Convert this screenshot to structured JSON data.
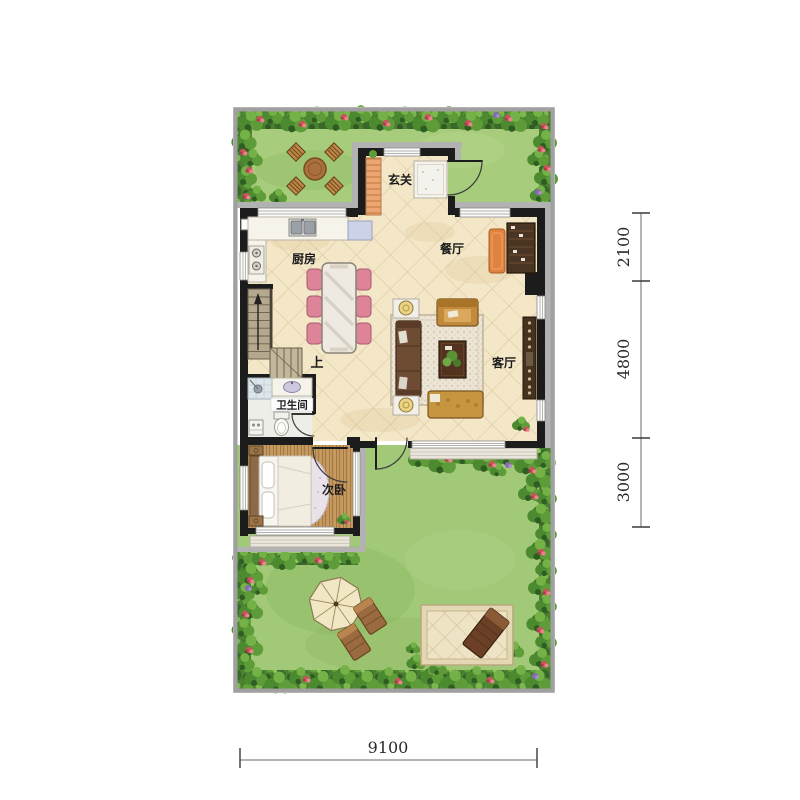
{
  "floorplan": {
    "title": "first-floor-plan-with-garden",
    "rooms": {
      "entrance": "玄关",
      "kitchen": "厨房",
      "dining": "餐厅",
      "living": "客厅",
      "bathroom": "卫生间",
      "bedroom": "次卧",
      "stairs_up": "上"
    },
    "dimensions": {
      "right": [
        "2100",
        "4800",
        "3000"
      ],
      "bottom": "9100"
    },
    "colors": {
      "grass": "#a5cb7b",
      "foliage_dark": "#3f7a2c",
      "foliage_light": "#74b248",
      "flower_red": "#c8545c",
      "flower_purple": "#8a68b4",
      "floor_tile": "#f3e7c7",
      "wall": "#1c1c1c",
      "fence_gray": "#a0a0a0",
      "wood_floor": "#c79a60",
      "dining_chair_pink": "#dd8498",
      "sofa_brown": "#6e4b33",
      "accent_gold": "#c28a3c",
      "cabinet_brown": "#46321f",
      "umbrella_cream": "#f2e7c5",
      "rug_orange": "#e08340"
    }
  }
}
